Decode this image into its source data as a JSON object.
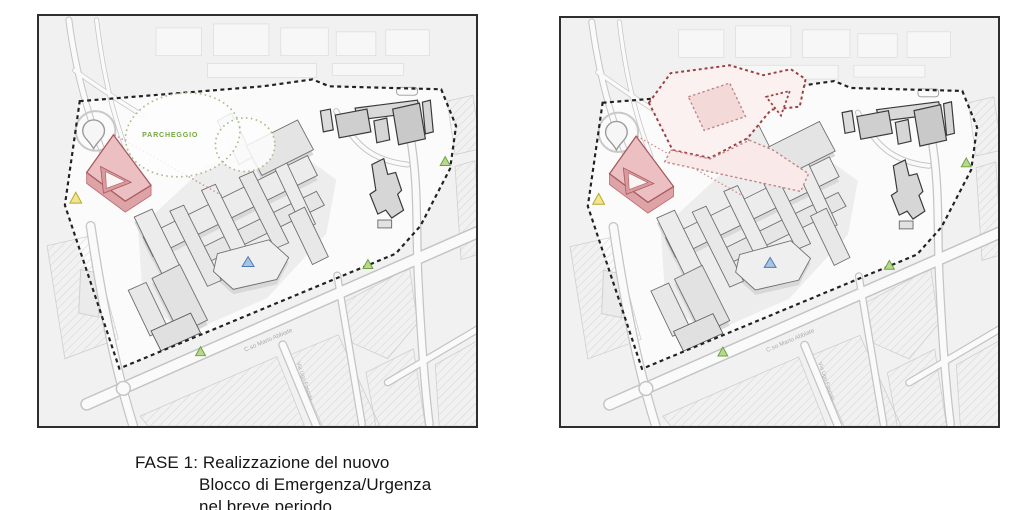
{
  "panels": [
    {
      "name": "FASE 1",
      "caption_prefix": "FASE 1:",
      "caption_line1": "Realizzazione del nuovo",
      "caption_line2": "Blocco di Emergenza/Urgenza",
      "caption_line3": "nel breve periodo"
    },
    {
      "name": "FASE 2",
      "caption_prefix": "FASE 2:",
      "caption_line1": "Costruzione del nuovo",
      "caption_line2": "Ospedale garantendo",
      "caption_line3": "l’operatività del P.O. esistente"
    }
  ],
  "map_labels": {
    "parking": "PARCHEGGIO",
    "street_main": "C.so Mario Abbiate",
    "street_cross": "Via Ugo Foscolo"
  },
  "markers": [
    {
      "name": "yellow-access-marker",
      "color": "#e8d44d"
    },
    {
      "name": "blue-access-marker",
      "color": "#5b87bb"
    },
    {
      "name": "green-access-marker",
      "color": "#8fc556"
    }
  ],
  "colors": {
    "site_boundary": "#222222",
    "new_block_fill": "#ecbfc2",
    "new_block_stroke": "#a85a5e",
    "phase2_footprint_stroke": "#9c4040",
    "phase2_footprint_fill": "#fbf1f0",
    "parking_outline": "#a9bc8b",
    "parking_text": "#76a843",
    "building_fill": "#ececec",
    "building_stroke": "#6f6f6f",
    "dark_building_stroke": "#3a3a3a",
    "road": "#c4c4c4",
    "map_background": "#f1f1f1"
  }
}
